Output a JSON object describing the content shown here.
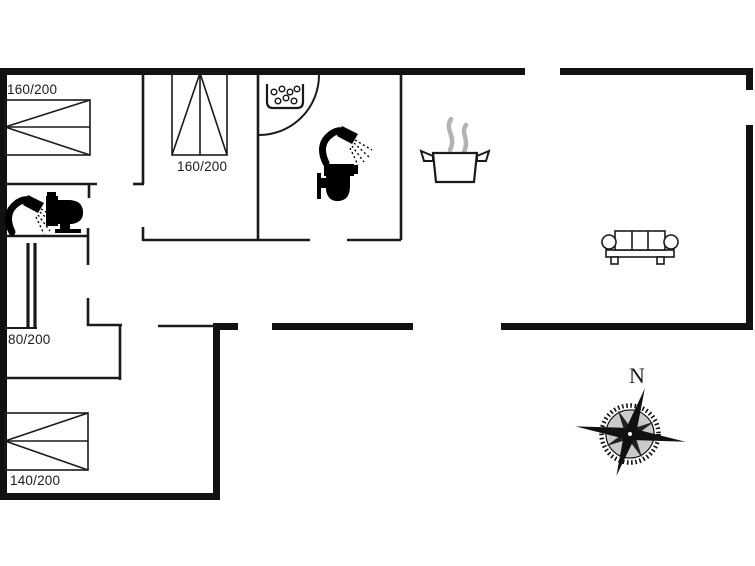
{
  "image_type": "holiday-home-floor-plan",
  "colors": {
    "background": "#ffffff",
    "wall": "#111111",
    "thin_line": "#1a1a1a",
    "steam": "#b3b3b3"
  },
  "labels": {
    "bed_top_left": "160/200",
    "bed_middle_room": "160/200",
    "bed_single": "80/200",
    "bed_bottom_left": "140/200",
    "compass_north": "N"
  },
  "icons": [
    "double-bed-icon",
    "single-bed-icon",
    "shower-icon",
    "toilet-icon",
    "whirlpool-tub-icon",
    "cooking-pot-icon",
    "sofa-icon",
    "compass-rose-icon",
    "door-swing-arc"
  ]
}
